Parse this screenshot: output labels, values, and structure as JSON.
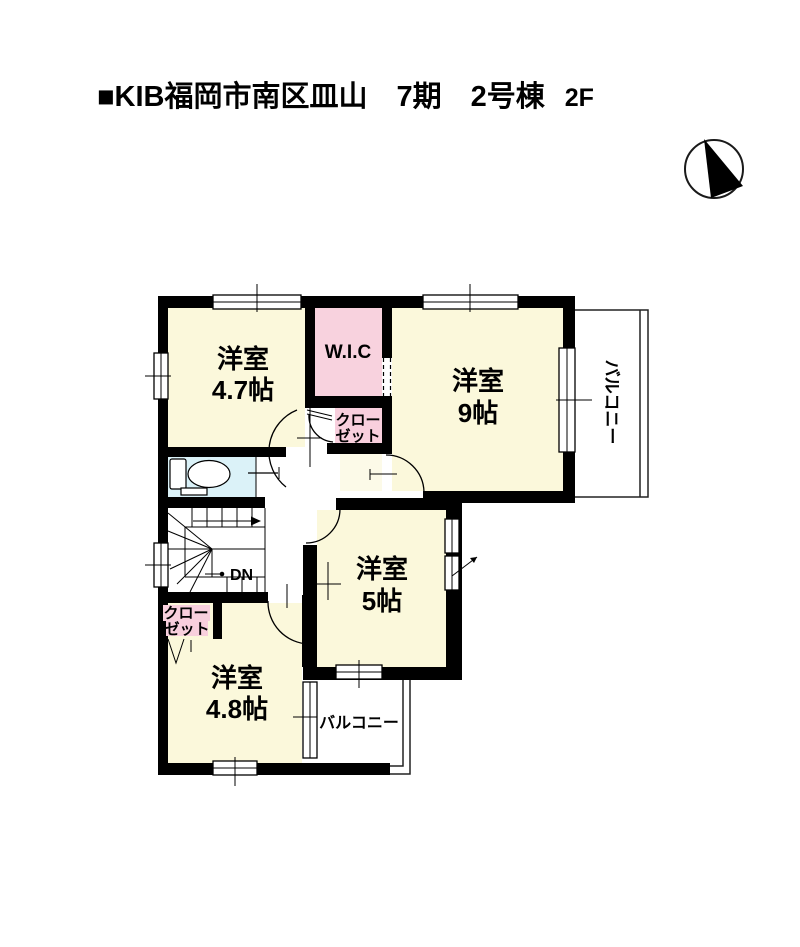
{
  "header": {
    "title": "■KIB福岡市南区皿山　7期　2号棟",
    "floor": "2F"
  },
  "compass": {
    "icon": "north-arrow"
  },
  "floorplan": {
    "rooms": {
      "room47": {
        "name": "洋室",
        "size": "4.7帖"
      },
      "room9": {
        "name": "洋室",
        "size": "9帖"
      },
      "room5": {
        "name": "洋室",
        "size": "5帖"
      },
      "room48": {
        "name": "洋室",
        "size": "4.8帖"
      },
      "wic": {
        "label": "W.I.C"
      },
      "closet_top": {
        "line1": "クロー",
        "line2": "ゼット"
      },
      "closet_bottom": {
        "line1": "クロー",
        "line2": "ゼット"
      },
      "balcony_right": {
        "label": "バルコニー"
      },
      "balcony_bottom": {
        "label": "バルコニー"
      },
      "stairs": {
        "label": "DN"
      }
    },
    "colors": {
      "wall": "#000000",
      "room_fill": "#FBF8DB",
      "wic_fill": "#F8D2DE",
      "toilet_fill": "#DBF2F8",
      "pale_fill": "#FCFAE8",
      "pink_label": "#F8CFDD"
    }
  }
}
